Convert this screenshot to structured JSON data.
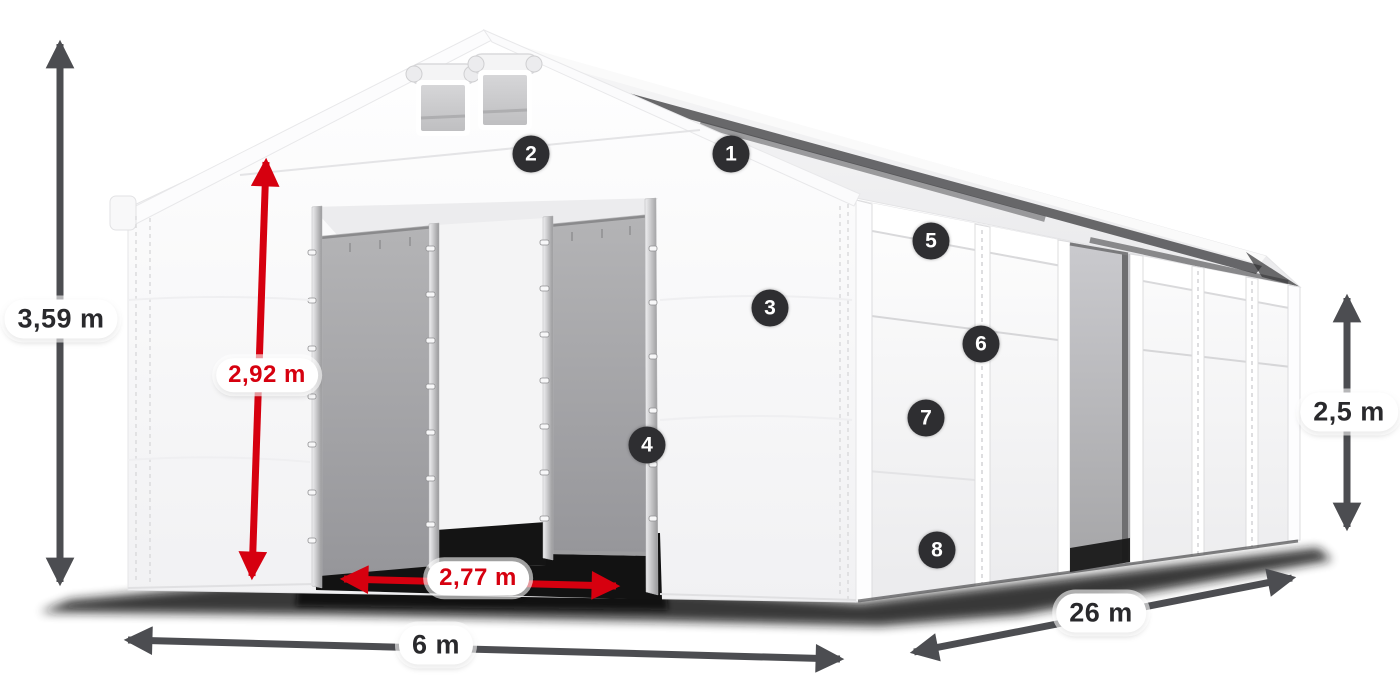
{
  "diagram": {
    "type": "tent-dimension-diagram",
    "dimensions": {
      "total_height": {
        "value": "3,59 m",
        "color": "dark",
        "arrow": "vertical-double-arrow"
      },
      "entrance_height": {
        "value": "2,92 m",
        "color": "red",
        "arrow": "vertical-double-arrow"
      },
      "entrance_width": {
        "value": "2,77 m",
        "color": "red",
        "arrow": "horizontal-double-arrow"
      },
      "gable_width": {
        "value": "6 m",
        "color": "dark",
        "arrow": "horizontal-double-arrow"
      },
      "side_length": {
        "value": "26 m",
        "color": "dark",
        "arrow": "diagonal-double-arrow"
      },
      "side_height": {
        "value": "2,5 m",
        "color": "dark",
        "arrow": "vertical-double-arrow"
      }
    },
    "callouts": [
      {
        "number": "1"
      },
      {
        "number": "2"
      },
      {
        "number": "3"
      },
      {
        "number": "4"
      },
      {
        "number": "5"
      },
      {
        "number": "6"
      },
      {
        "number": "7"
      },
      {
        "number": "8"
      }
    ],
    "colors": {
      "dimension_dark": "#4c4d51",
      "dimension_red": "#d6000f",
      "badge_background": "#2e2e31",
      "label_background": "#ffffff",
      "label_text": "#29292c",
      "page_background": "#ffffff"
    }
  }
}
